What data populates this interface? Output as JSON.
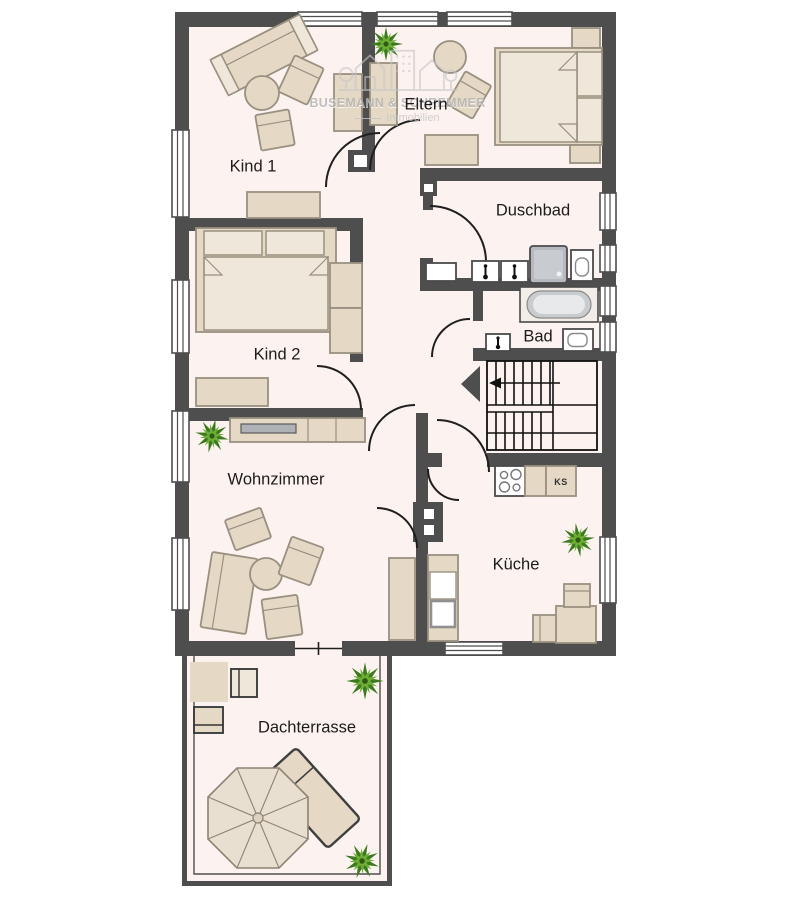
{
  "watermark": {
    "line1": "BUSEMANN & SCHREMMER",
    "line2": "Immobilien"
  },
  "rooms": {
    "kind1": "Kind 1",
    "eltern": "Eltern",
    "duschbad": "Duschbad",
    "kind2": "Kind 2",
    "bad": "Bad",
    "wohnzimmer": "Wohnzimmer",
    "kueche": "Küche",
    "dachterrasse": "Dachterrasse"
  },
  "kitchen": {
    "fridge_label": "KS"
  },
  "colors": {
    "wall": "#4e4e4e",
    "floor": "#fcf2ef",
    "furn": "#e5d9c6",
    "furn-light": "#efe7da",
    "furn-stroke": "#9a9080",
    "arc": "#1f1f1f",
    "plant-dark": "#3b7a1e",
    "plant-light": "#6fae35",
    "watermark": "#b2b2b2",
    "fixture-stroke": "#4a4a4a"
  }
}
